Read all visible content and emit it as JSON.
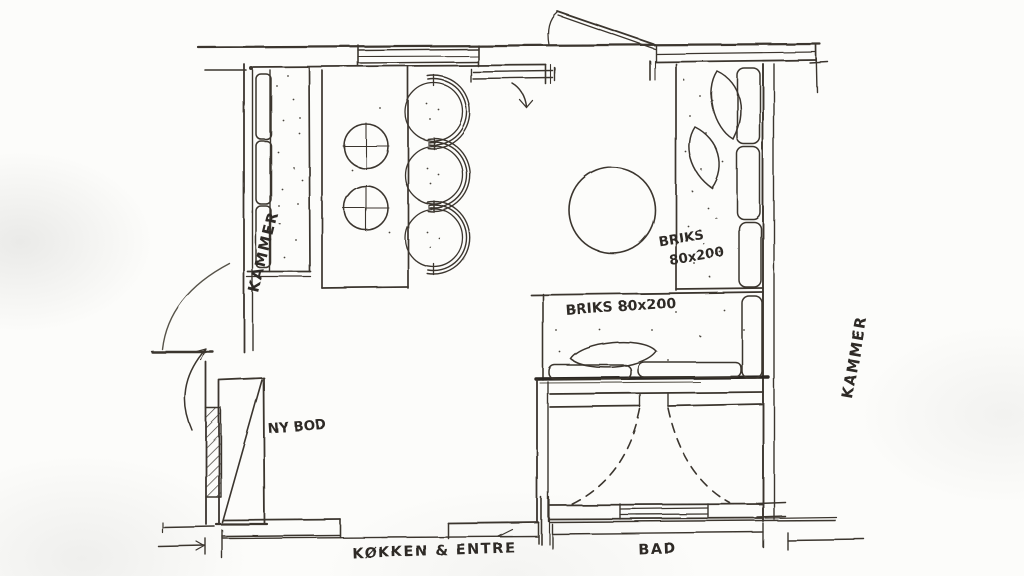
{
  "plan": {
    "type": "hand-drawn floor plan sketch",
    "labels": {
      "kammer_left": "KAMMER",
      "kammer_right": "KAMMER",
      "briks_right_line1": "BRIKS",
      "briks_right_line2": "80x200",
      "briks_bottom": "BRIKS 80x200",
      "ny_bod": "NY BOD",
      "kokken_entre": "KØKKEN & ENTRE",
      "bad": "BAD"
    },
    "colors": {
      "paper": "#fcfcfa",
      "ink": "#3b362f"
    }
  }
}
